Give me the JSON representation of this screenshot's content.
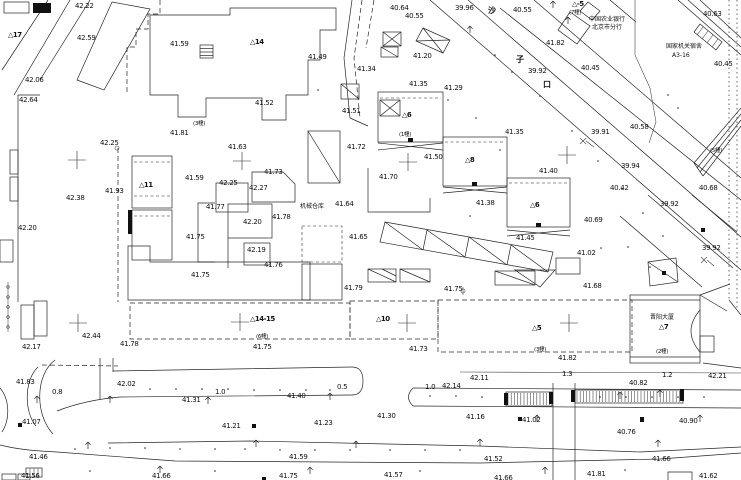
{
  "map": {
    "colors": {
      "ink": "#262626",
      "bg": "#ffffff"
    },
    "labels": [
      [
        "42.22",
        75,
        2,
        "e"
      ],
      [
        "42.59",
        77,
        34,
        "e"
      ],
      [
        "41.59",
        170,
        40,
        "e"
      ],
      [
        "42.06",
        25,
        76,
        "e"
      ],
      [
        "42.64",
        19,
        96,
        "e"
      ],
      [
        "40.64",
        390,
        4,
        "e"
      ],
      [
        "40.55",
        405,
        12,
        "e"
      ],
      [
        "39.96",
        455,
        4,
        "e"
      ],
      [
        "40.55",
        513,
        6,
        "e"
      ],
      [
        "41.82",
        546,
        39,
        "e"
      ],
      [
        "40.45",
        581,
        64,
        "e"
      ],
      [
        "39.92",
        528,
        67,
        "e"
      ],
      [
        "41.20",
        413,
        52,
        "e"
      ],
      [
        "41.34",
        357,
        65,
        "e"
      ],
      [
        "41.35",
        409,
        80,
        "e"
      ],
      [
        "41.29",
        444,
        84,
        "e"
      ],
      [
        "40.63",
        703,
        10,
        "e"
      ],
      [
        "40.45",
        714,
        60,
        "e"
      ],
      [
        "41.49",
        308,
        53,
        "e"
      ],
      [
        "41.52",
        255,
        99,
        "e"
      ],
      [
        "41.51",
        342,
        107,
        "e"
      ],
      [
        "42.25",
        100,
        139,
        "e"
      ],
      [
        "41.81",
        170,
        129,
        "e"
      ],
      [
        "41.93",
        105,
        187,
        "e"
      ],
      [
        "41.59",
        185,
        174,
        "e"
      ],
      [
        "42.25",
        219,
        179,
        "e"
      ],
      [
        "42.27",
        249,
        184,
        "e"
      ],
      [
        "41.63",
        228,
        143,
        "e"
      ],
      [
        "41.73",
        264,
        168,
        "e"
      ],
      [
        "41.77",
        206,
        203,
        "e"
      ],
      [
        "42.20",
        243,
        218,
        "e"
      ],
      [
        "41.78",
        272,
        213,
        "e"
      ],
      [
        "42.19",
        247,
        246,
        "e"
      ],
      [
        "41.75",
        186,
        233,
        "e"
      ],
      [
        "41.76",
        264,
        261,
        "e"
      ],
      [
        "41.75",
        191,
        271,
        "e"
      ],
      [
        "41.72",
        347,
        143,
        "e"
      ],
      [
        "41.64",
        335,
        200,
        "e"
      ],
      [
        "41.65",
        349,
        233,
        "e"
      ],
      [
        "42.38",
        66,
        194,
        "e"
      ],
      [
        "42.20",
        18,
        224,
        "e"
      ],
      [
        "41.50",
        424,
        153,
        "e"
      ],
      [
        "41.35",
        505,
        128,
        "e"
      ],
      [
        "41.40",
        539,
        167,
        "e"
      ],
      [
        "41.38",
        476,
        199,
        "e"
      ],
      [
        "41.45",
        516,
        234,
        "e"
      ],
      [
        "41.70",
        379,
        173,
        "e"
      ],
      [
        "40.69",
        584,
        216,
        "e"
      ],
      [
        "41.02",
        577,
        249,
        "e"
      ],
      [
        "41.68",
        583,
        282,
        "e"
      ],
      [
        "39.91",
        591,
        128,
        "e"
      ],
      [
        "40.58",
        630,
        123,
        "e"
      ],
      [
        "39.94",
        621,
        162,
        "e"
      ],
      [
        "40.42",
        610,
        184,
        "e"
      ],
      [
        "40.68",
        699,
        184,
        "e"
      ],
      [
        "39.92",
        660,
        200,
        "e"
      ],
      [
        "39.92",
        702,
        244,
        "e"
      ],
      [
        "41.79",
        344,
        284,
        "e"
      ],
      [
        "41.75",
        444,
        285,
        "e"
      ],
      [
        "41.73",
        409,
        345,
        "e"
      ],
      [
        "41.75",
        253,
        343,
        "e"
      ],
      [
        "41.82",
        558,
        354,
        "e"
      ],
      [
        "42.21",
        708,
        372,
        "e"
      ],
      [
        "41.78",
        120,
        340,
        "e"
      ],
      [
        "42.44",
        82,
        332,
        "e"
      ],
      [
        "42.17",
        22,
        343,
        "e"
      ],
      [
        "41.83",
        16,
        378,
        "e"
      ],
      [
        "42.02",
        117,
        380,
        "e"
      ],
      [
        "41.31",
        182,
        396,
        "e"
      ],
      [
        "41.40",
        287,
        392,
        "e"
      ],
      [
        "42.14",
        442,
        382,
        "e"
      ],
      [
        "42.11",
        470,
        374,
        "e"
      ],
      [
        "40.82",
        629,
        379,
        "e"
      ],
      [
        "41.07",
        22,
        418,
        "e"
      ],
      [
        "41.23",
        314,
        419,
        "e"
      ],
      [
        "41.30",
        377,
        412,
        "e"
      ],
      [
        "41.16",
        466,
        413,
        "e"
      ],
      [
        "41.21",
        222,
        422,
        "e"
      ],
      [
        "41.02",
        522,
        416,
        "e"
      ],
      [
        "40.90",
        679,
        417,
        "e"
      ],
      [
        "40.76",
        617,
        428,
        "e"
      ],
      [
        "41.46",
        29,
        453,
        "e"
      ],
      [
        "41.59",
        289,
        453,
        "e"
      ],
      [
        "41.52",
        484,
        455,
        "e"
      ],
      [
        "41.66",
        652,
        455,
        "e"
      ],
      [
        "41.56",
        21,
        472,
        "e"
      ],
      [
        "41.66",
        152,
        472,
        "e"
      ],
      [
        "41.75",
        279,
        472,
        "e"
      ],
      [
        "41.57",
        384,
        471,
        "e"
      ],
      [
        "41.66",
        494,
        474,
        "e"
      ],
      [
        "41.81",
        587,
        470,
        "e"
      ],
      [
        "41.62",
        699,
        472,
        "e"
      ],
      [
        "△17",
        8,
        31,
        "b"
      ],
      [
        "△14",
        250,
        38,
        "b"
      ],
      [
        "△-5",
        572,
        0,
        "b"
      ],
      [
        "△11",
        139,
        181,
        "b"
      ],
      [
        "△6",
        402,
        111,
        "b"
      ],
      [
        "△8",
        465,
        156,
        "b"
      ],
      [
        "△6",
        530,
        201,
        "b"
      ],
      [
        "△14-15",
        250,
        315,
        "b"
      ],
      [
        "△10",
        376,
        315,
        "b"
      ],
      [
        "△5",
        532,
        324,
        "b"
      ],
      [
        "△7",
        659,
        323,
        "b"
      ],
      [
        "(7幢)",
        569,
        8,
        "c"
      ],
      [
        "(3幢)",
        193,
        119,
        "c"
      ],
      [
        "(1幢)",
        399,
        130,
        "c"
      ],
      [
        "(6幢)",
        256,
        332,
        "c"
      ],
      [
        "(3幢)",
        534,
        345,
        "c"
      ],
      [
        "(2幢)",
        656,
        347,
        "c"
      ],
      [
        "(5幢)",
        710,
        146,
        "c"
      ],
      [
        "中国农业银行",
        589,
        14,
        "n"
      ],
      [
        "北京市分行",
        592,
        22,
        "n"
      ],
      [
        "国家机关宿舍",
        666,
        41,
        "n"
      ],
      [
        "A3-16",
        672,
        52,
        "n"
      ],
      [
        "机械仓库",
        300,
        201,
        "n"
      ],
      [
        "晋阳大厦",
        650,
        312,
        "n"
      ],
      [
        "沙",
        488,
        5,
        "r"
      ],
      [
        "子",
        516,
        54,
        "r"
      ],
      [
        "口",
        543,
        79,
        "r"
      ],
      [
        "0.8",
        52,
        388,
        "w"
      ],
      [
        "1.0",
        215,
        388,
        "w"
      ],
      [
        "0.5",
        337,
        383,
        "w"
      ],
      [
        "1.0",
        425,
        383,
        "w"
      ],
      [
        "1.3",
        562,
        370,
        "w"
      ],
      [
        "1.2",
        662,
        371,
        "w"
      ]
    ],
    "symbols": {
      "crosses": [
        [
          77,
          160
        ],
        [
          242,
          161
        ],
        [
          408,
          162
        ],
        [
          567,
          155
        ],
        [
          78,
          323
        ],
        [
          240,
          322
        ],
        [
          407,
          323
        ],
        [
          569,
          323
        ]
      ],
      "trees": [
        [
          553,
          7
        ],
        [
          568,
          23
        ],
        [
          470,
          32
        ],
        [
          37,
          402
        ],
        [
          110,
          402
        ],
        [
          208,
          403
        ],
        [
          330,
          399
        ],
        [
          660,
          396
        ],
        [
          88,
          448
        ],
        [
          256,
          446
        ],
        [
          356,
          447
        ],
        [
          480,
          445
        ],
        [
          658,
          446
        ],
        [
          537,
          421
        ],
        [
          700,
          421
        ],
        [
          160,
          472
        ],
        [
          310,
          473
        ],
        [
          545,
          473
        ],
        [
          620,
          398
        ]
      ],
      "dots": [
        [
          150,
          389
        ],
        [
          176,
          389
        ],
        [
          202,
          389
        ],
        [
          228,
          389
        ],
        [
          254,
          390
        ],
        [
          280,
          390
        ],
        [
          306,
          390
        ],
        [
          330,
          390
        ],
        [
          430,
          396
        ],
        [
          456,
          396
        ],
        [
          482,
          397
        ],
        [
          600,
          397
        ],
        [
          626,
          397
        ],
        [
          652,
          397
        ],
        [
          678,
          397
        ],
        [
          704,
          397
        ],
        [
          75,
          449
        ],
        [
          110,
          448
        ],
        [
          145,
          448
        ],
        [
          180,
          449
        ],
        [
          215,
          449
        ],
        [
          245,
          449
        ],
        [
          280,
          450
        ],
        [
          315,
          450
        ],
        [
          350,
          450
        ],
        [
          390,
          450
        ],
        [
          425,
          450
        ],
        [
          460,
          450
        ],
        [
          90,
          471
        ],
        [
          215,
          471
        ],
        [
          420,
          471
        ],
        [
          625,
          470
        ],
        [
          495,
          55
        ],
        [
          512,
          72
        ],
        [
          540,
          96
        ],
        [
          572,
          131
        ],
        [
          598,
          161
        ],
        [
          622,
          189
        ],
        [
          643,
          213
        ],
        [
          663,
          236
        ],
        [
          628,
          247
        ],
        [
          650,
          267
        ],
        [
          601,
          248
        ],
        [
          448,
          100
        ],
        [
          476,
          118
        ],
        [
          500,
          150
        ],
        [
          470,
          216
        ],
        [
          668,
          95
        ],
        [
          678,
          108
        ],
        [
          318,
          90
        ]
      ],
      "marks": [
        [
          408,
          138,
          5,
          4
        ],
        [
          472,
          182,
          5,
          4
        ],
        [
          536,
          223,
          5,
          4
        ],
        [
          662,
          271,
          4,
          4
        ],
        [
          701,
          228,
          4,
          4
        ],
        [
          18,
          423,
          4,
          4
        ],
        [
          252,
          424,
          4,
          4
        ],
        [
          262,
          477,
          4,
          4
        ],
        [
          640,
          417,
          4,
          5
        ],
        [
          518,
          417,
          4,
          4
        ],
        [
          128,
          210,
          4,
          24
        ],
        [
          33,
          3,
          18,
          10
        ],
        [
          504,
          393,
          4,
          12
        ],
        [
          549,
          392,
          4,
          12
        ],
        [
          571,
          390,
          4,
          12
        ],
        [
          680,
          389,
          4,
          12
        ]
      ]
    }
  }
}
